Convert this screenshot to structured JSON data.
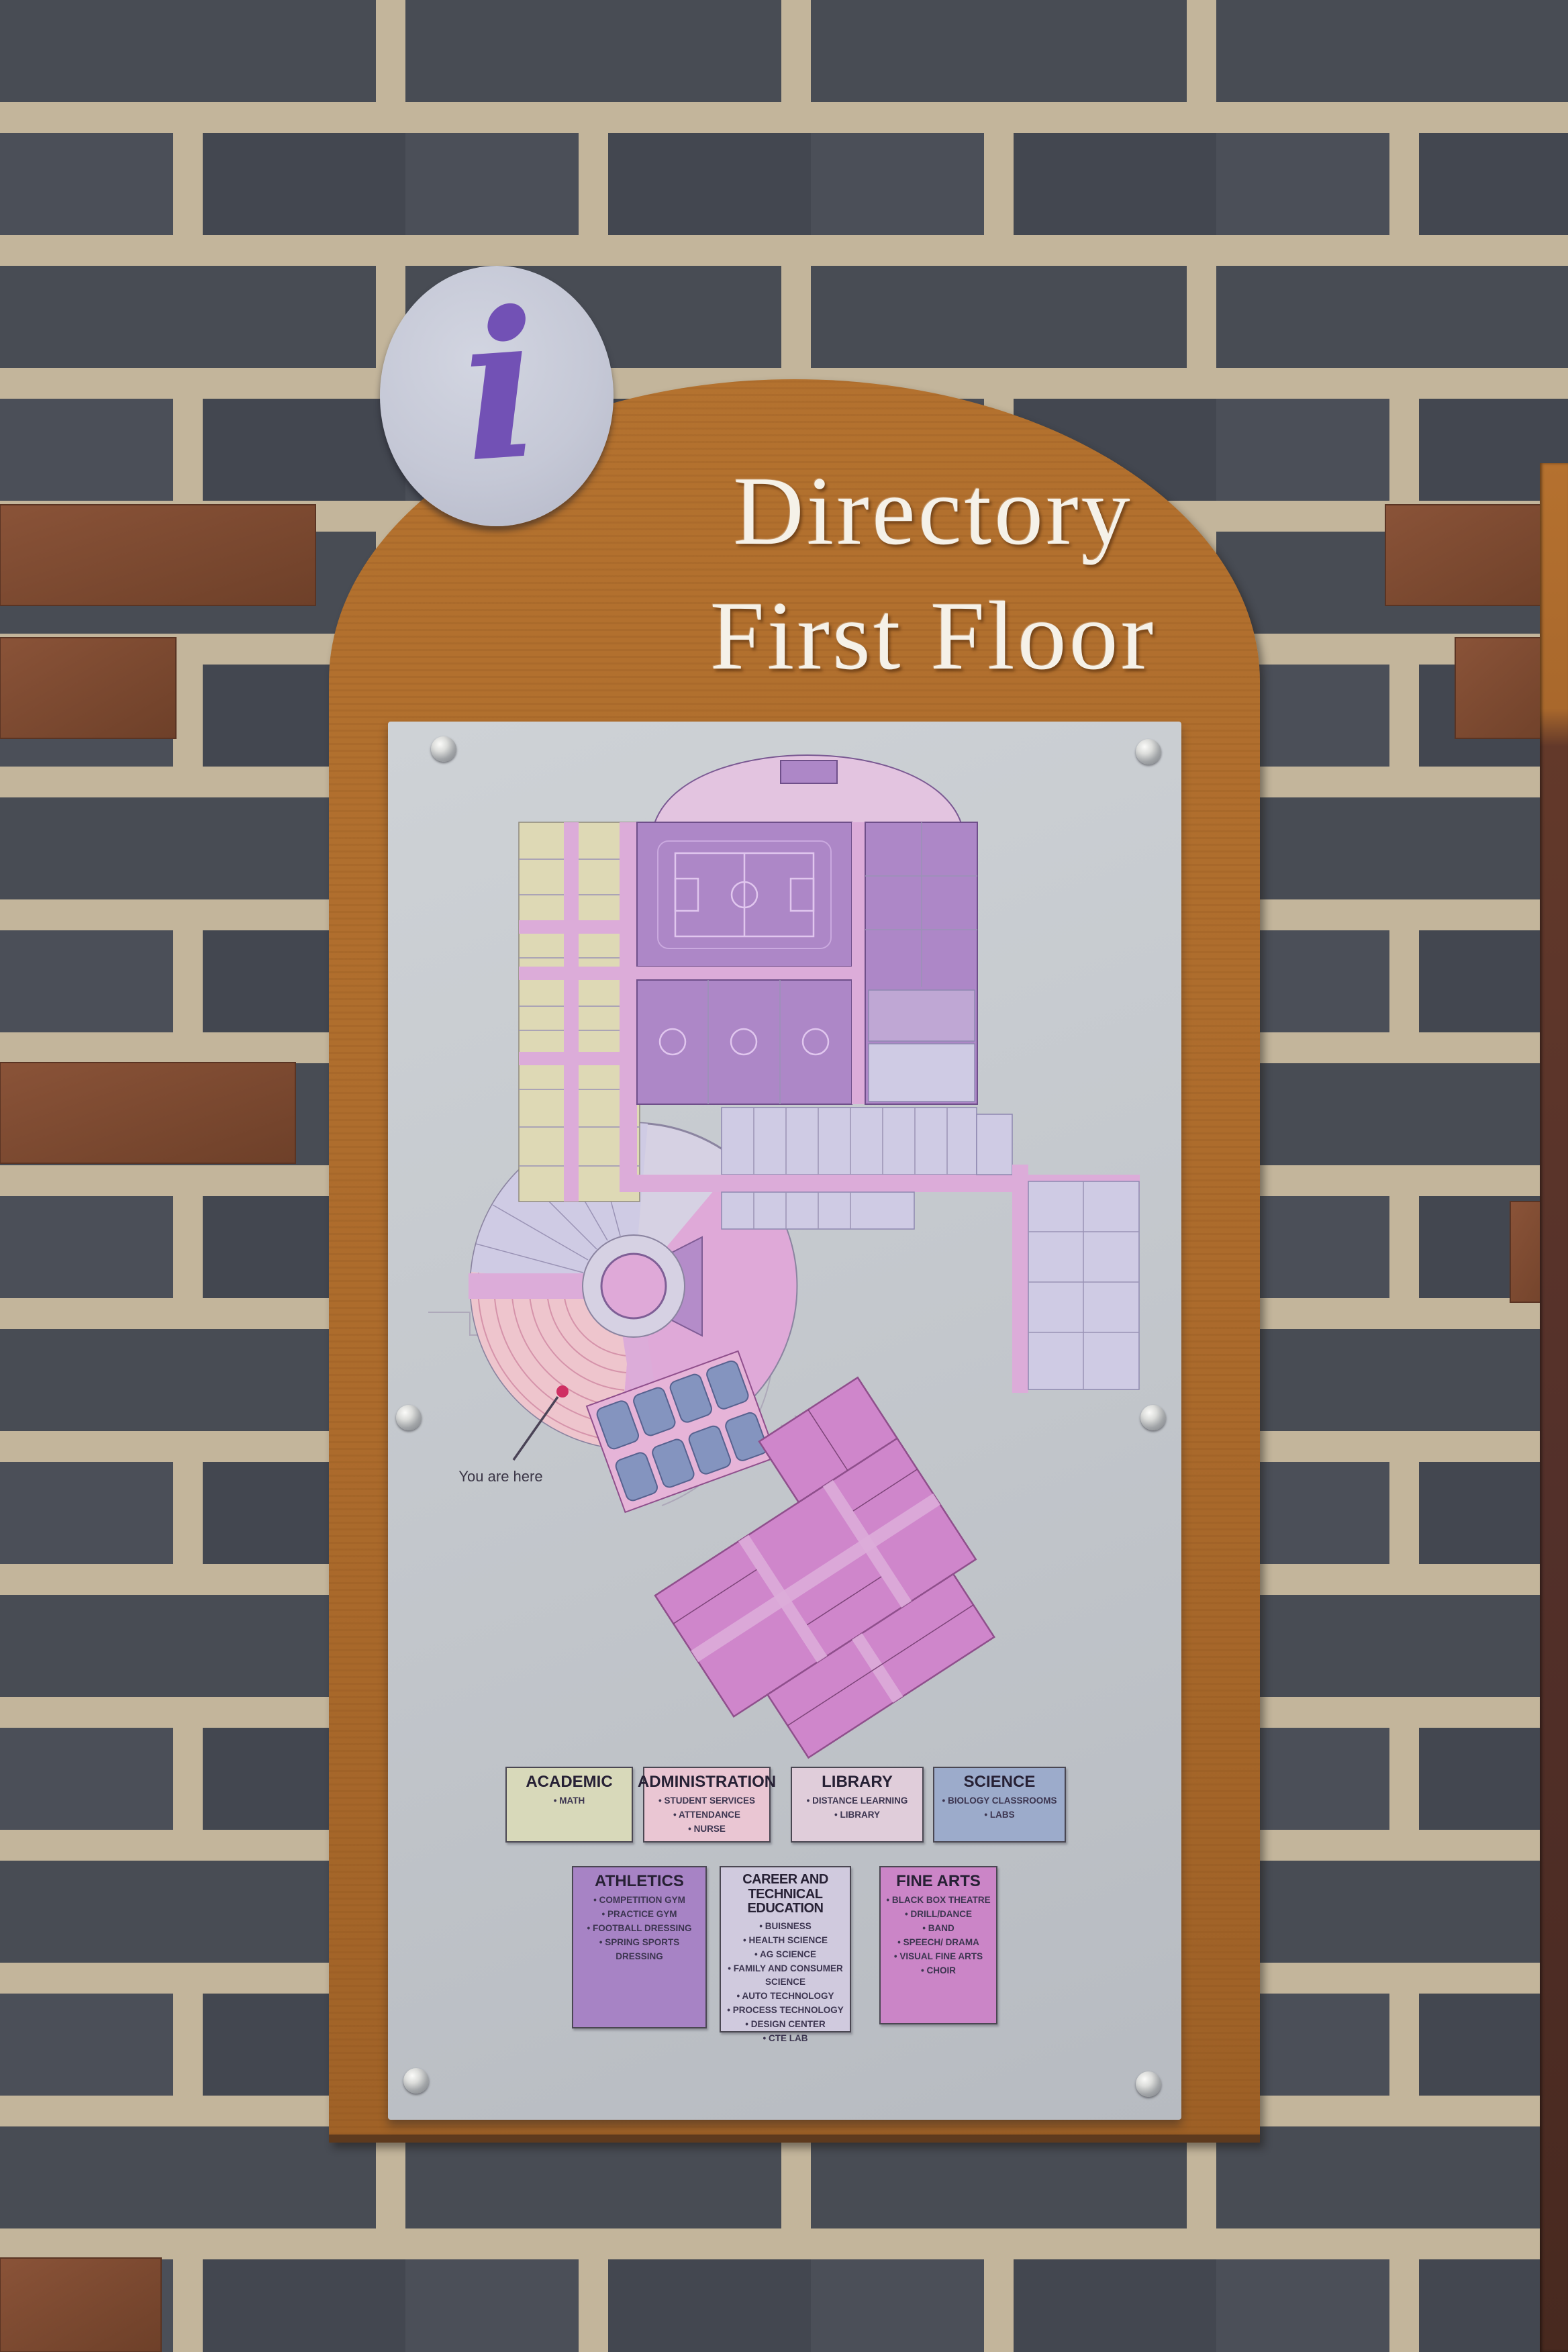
{
  "scene": {
    "description": "School directory sign with first-floor map mounted on a brick wall",
    "wall": {
      "brick_color": "#484c54",
      "mortar_color": "#c3b59b",
      "accent_brick_color": "#7d4b32"
    },
    "board": {
      "wood_color": "#ab6c2e"
    },
    "adjacent_sign_edge_color": "#53302a",
    "plate_color": "#c4c8cd"
  },
  "sign": {
    "info_symbol": "i",
    "info_symbol_color": "#7251b5",
    "title_line1": "Directory",
    "title_line2": "First Floor",
    "you_are_here_label": "You are here",
    "marker_color": "#cf2f63"
  },
  "map_areas": {
    "academic": "#ded9b5",
    "administration": "#eabcd2",
    "library": "#d6cde2",
    "science": "#8494bf",
    "athletics": "#ad87c7",
    "career_technical": "#cfcbe4",
    "fine_arts": "#cf86cb",
    "corridor": "#dcacd9"
  },
  "legend": {
    "row1": [
      {
        "name": "ACADEMIC",
        "color": "#d8d9ba",
        "items": [
          "MATH"
        ]
      },
      {
        "name": "ADMINISTRATION",
        "color": "#eac6d3",
        "items": [
          "STUDENT SERVICES",
          "ATTENDANCE",
          "NURSE"
        ]
      },
      {
        "name": "LIBRARY",
        "color": "#e0cdda",
        "items": [
          "DISTANCE LEARNING",
          "LIBRARY"
        ]
      },
      {
        "name": "SCIENCE",
        "color": "#9cabcb",
        "items": [
          "BIOLOGY CLASSROOMS",
          "LABS"
        ]
      }
    ],
    "row2": [
      {
        "name": "ATHLETICS",
        "color": "#a783c5",
        "items": [
          "COMPETITION GYM",
          "PRACTICE GYM",
          "FOOTBALL DRESSING",
          "SPRING SPORTS DRESSING"
        ]
      },
      {
        "name": "CAREER AND TECHNICAL EDUCATION",
        "color": "#d0cade",
        "items": [
          "BUISNESS",
          "HEALTH SCIENCE",
          "AG SCIENCE",
          "FAMILY AND CONSUMER SCIENCE",
          "AUTO TECHNOLOGY",
          "PROCESS TECHNOLOGY",
          "DESIGN CENTER",
          "CTE LAB"
        ]
      },
      {
        "name": "FINE ARTS",
        "color": "#cb85c7",
        "items": [
          "BLACK BOX THEATRE",
          "DRILL/DANCE",
          "BAND",
          "SPEECH/ DRAMA",
          "VISUAL FINE ARTS",
          "CHOIR"
        ]
      }
    ]
  }
}
